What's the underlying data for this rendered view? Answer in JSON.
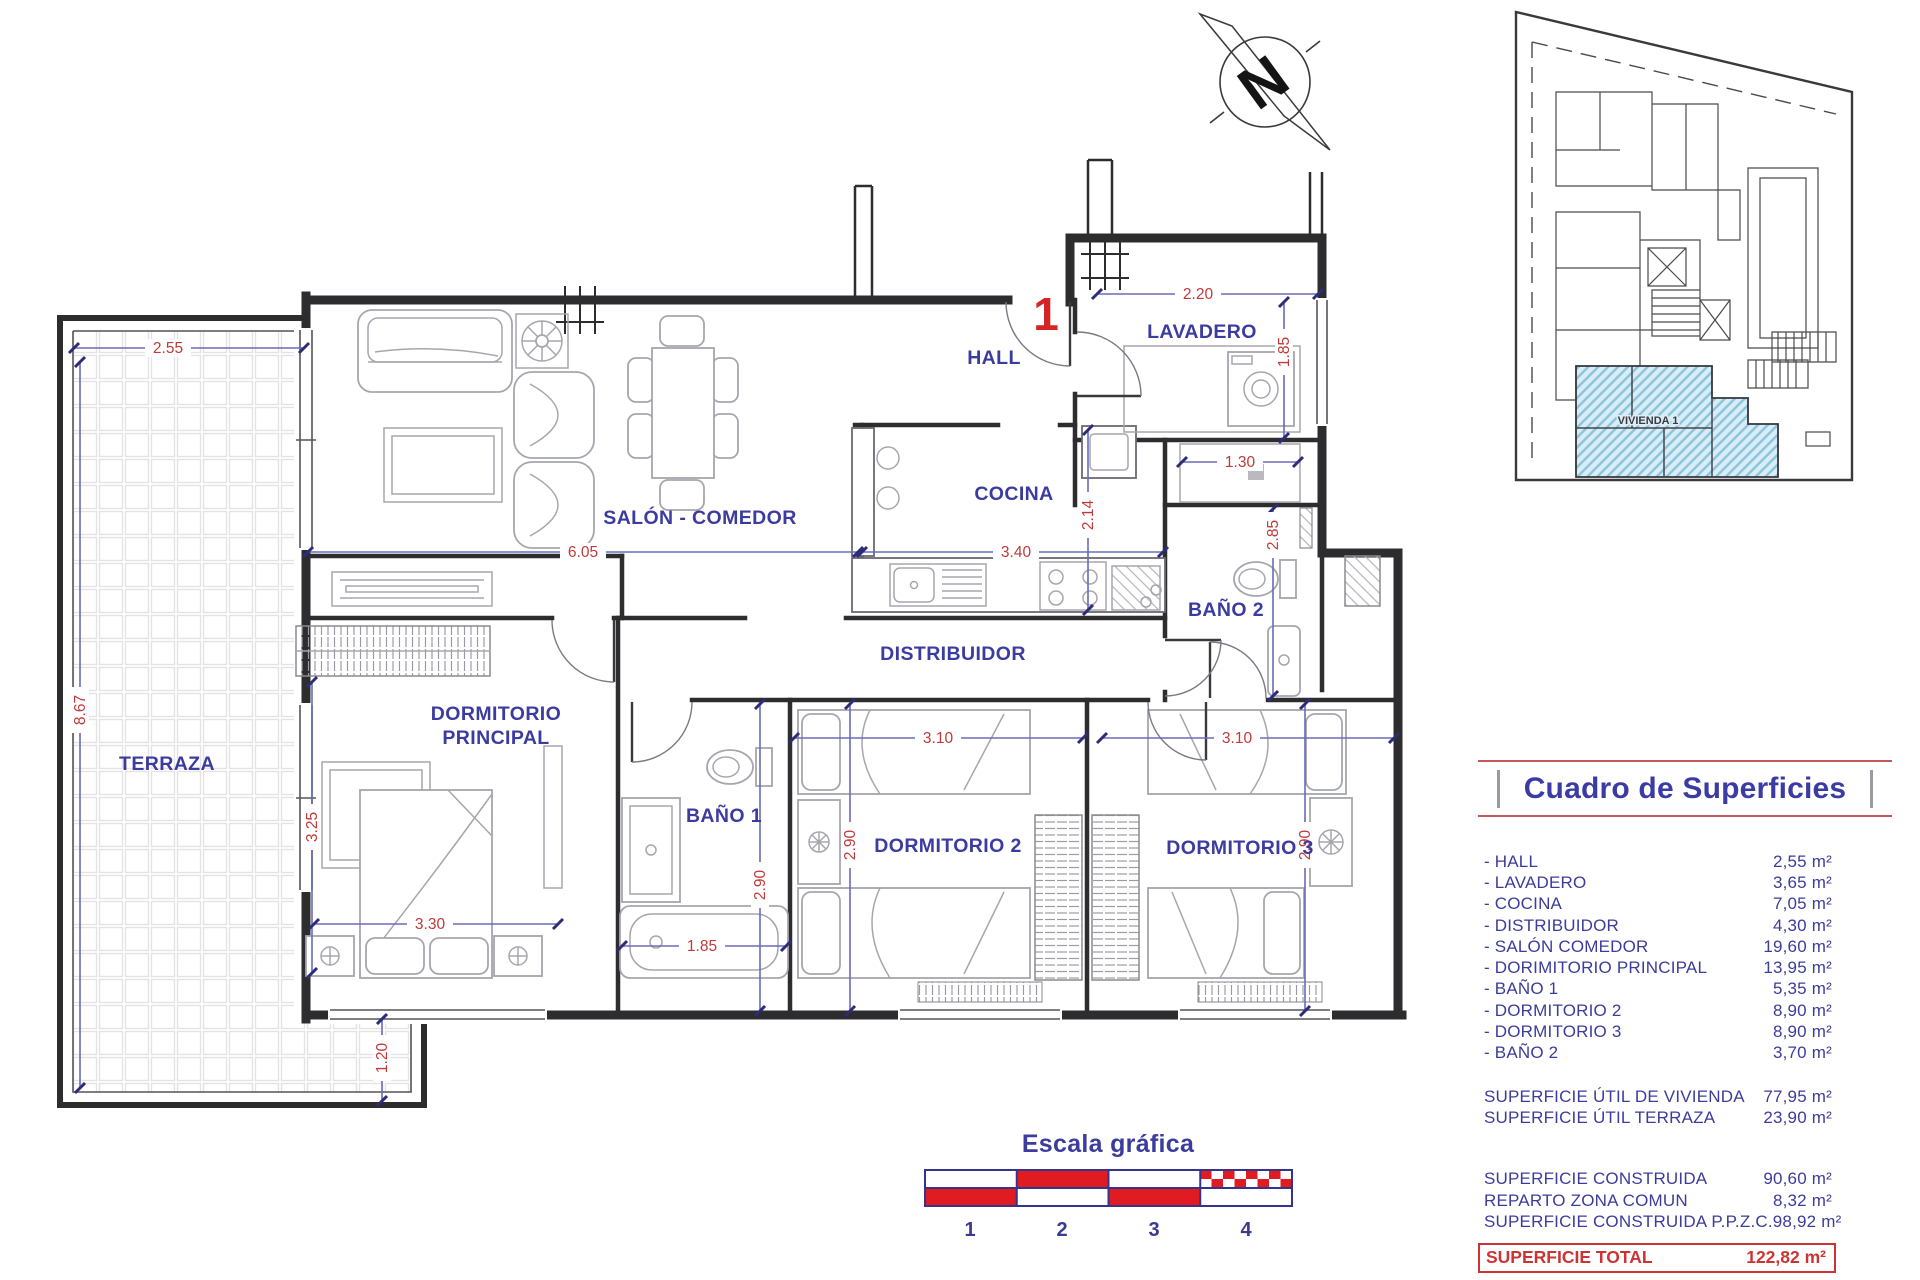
{
  "plan": {
    "unit_number": "1",
    "rooms": {
      "terraza": "TERRAZA",
      "salon": "SALÓN - COMEDOR",
      "hall": "HALL",
      "lavadero": "LAVADERO",
      "cocina": "COCINA",
      "bano2": "BAÑO 2",
      "distribuidor": "DISTRIBUIDOR",
      "dorm_ppal_line1": "DORMITORIO",
      "dorm_ppal_line2": "PRINCIPAL",
      "bano1": "BAÑO 1",
      "dorm2": "DORMITORIO 2",
      "dorm3": "DORMITORIO 3"
    },
    "dims": {
      "terraza_ancho": "2.55",
      "terraza_alto": "8.67",
      "salon_ancho": "6.05",
      "cocina_ancho": "3.40",
      "cocina_alto": "2.14",
      "lavadero_ancho": "2.20",
      "lavadero_alto": "1.85",
      "armario_ancho": "1.30",
      "bano2_alto": "2.85",
      "dorm_ppal_alto": "3.25",
      "dorm_ppal_ancho": "3.30",
      "bano1_ancho": "1.85",
      "bano1_alto": "2.90",
      "dorm2_ancho": "3.10",
      "dorm2_alto": "2.90",
      "dorm3_ancho": "3.10",
      "dorm3_alto": "2.90",
      "terraza_bajo": "1.20"
    }
  },
  "compass": {
    "letter": "N"
  },
  "site_plan": {
    "highlight_label": "VIVIENDA 1"
  },
  "scale_bar": {
    "title": "Escala gráfica",
    "ticks": [
      "1",
      "2",
      "3",
      "4"
    ]
  },
  "table": {
    "title": "Cuadro de Superficies",
    "rooms": [
      {
        "name": "- HALL",
        "value": "2,55 m²"
      },
      {
        "name": "- LAVADERO",
        "value": "3,65 m²"
      },
      {
        "name": "- COCINA",
        "value": "7,05 m²"
      },
      {
        "name": "- DISTRIBUIDOR",
        "value": "4,30 m²"
      },
      {
        "name": "- SALÓN COMEDOR",
        "value": "19,60 m²"
      },
      {
        "name": "- DORIMITORIO PRINCIPAL",
        "value": "13,95 m²"
      },
      {
        "name": "- BAÑO 1",
        "value": "5,35 m²"
      },
      {
        "name": "- DORMITORIO 2",
        "value": "8,90 m²"
      },
      {
        "name": "- DORMITORIO 3",
        "value": "8,90 m²"
      },
      {
        "name": "- BAÑO 2",
        "value": "3,70 m²"
      }
    ],
    "subtotals": [
      {
        "name": "SUPERFICIE ÚTIL DE VIVIENDA",
        "value": "77,95 m²"
      },
      {
        "name": "SUPERFICIE ÚTIL TERRAZA",
        "value": "23,90 m²"
      }
    ],
    "construction": [
      {
        "name": "SUPERFICIE CONSTRUIDA",
        "value": "90,60 m²"
      },
      {
        "name": "REPARTO ZONA COMUN",
        "value": "8,32 m²"
      },
      {
        "name": "SUPERFICIE CONSTRUIDA P.P.Z.C.",
        "value": "98,92 m²"
      }
    ],
    "total": {
      "name": "SUPERFICIE TOTAL",
      "value": "122,82 m²"
    }
  },
  "colors": {
    "room_label": "#3c3ca0",
    "dimension_text": "#c03a3a",
    "unit_red": "#d42525",
    "scale_red": "#e01b22",
    "table_rule": "#c25858",
    "total_red": "#cc3434",
    "site_hatch": "#8ac3dc"
  }
}
